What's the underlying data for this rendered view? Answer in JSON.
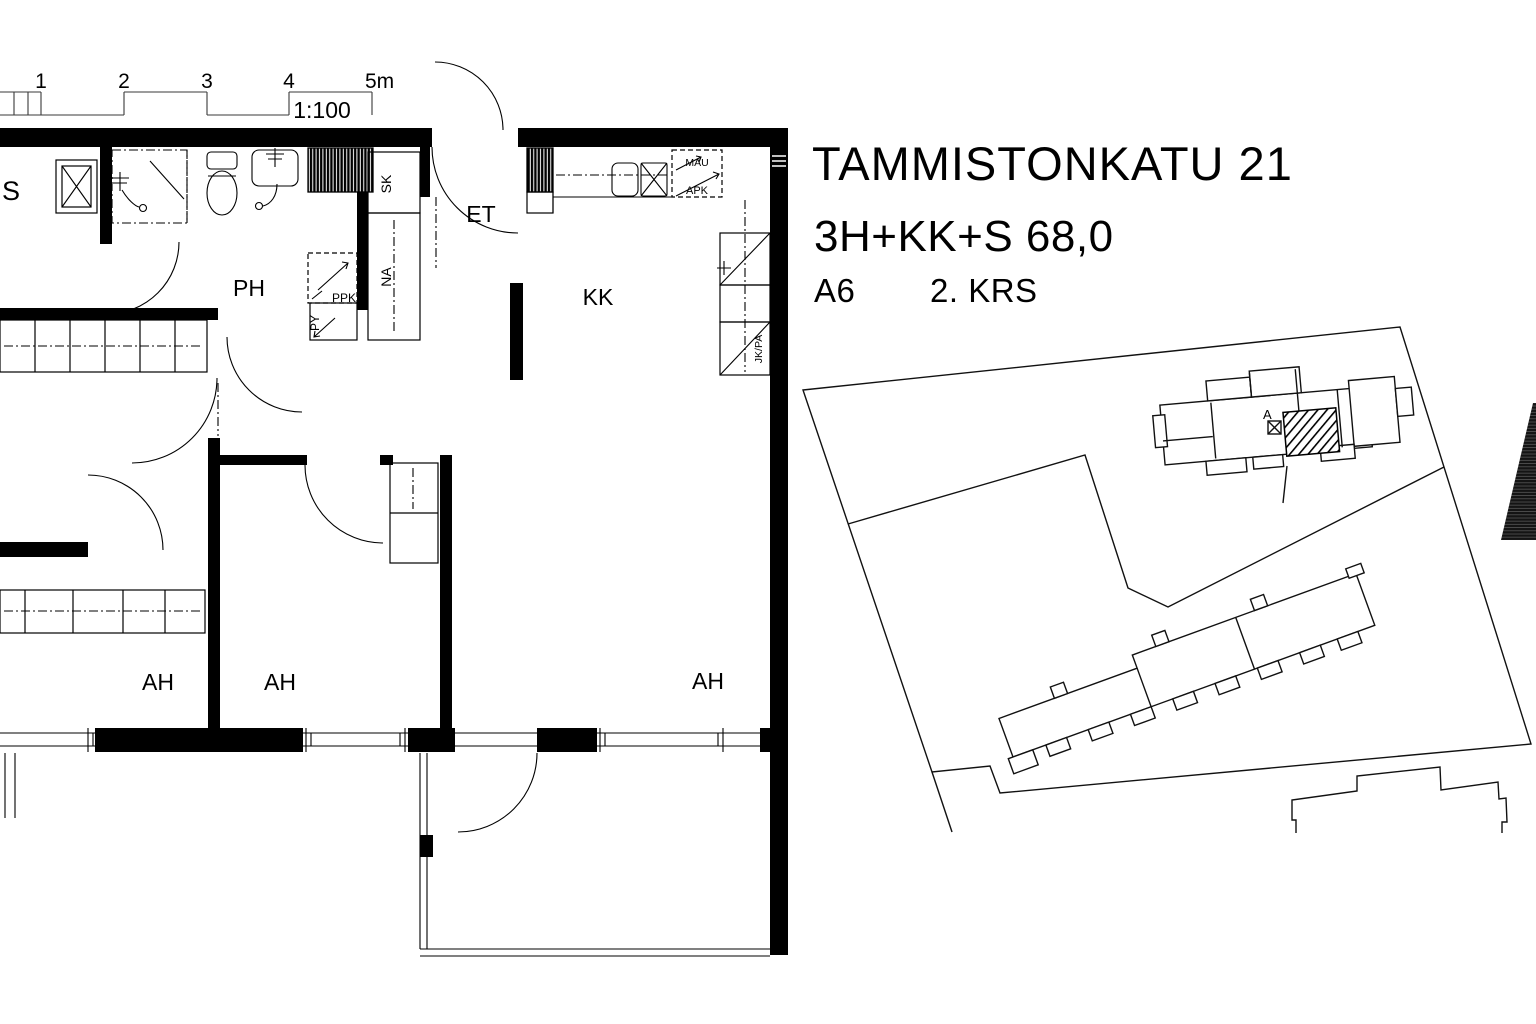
{
  "colors": {
    "ink": "#000000",
    "paper": "#ffffff"
  },
  "title_block": {
    "address": "TAMMISTONKATU 21",
    "layout_area": "3H+KK+S 68,0",
    "unit": "A6",
    "floor": "2. KRS"
  },
  "scale_bar": {
    "ticks": [
      "1",
      "2",
      "3",
      "4",
      "5m"
    ],
    "ratio": "1:100"
  },
  "rooms": {
    "sauna": "S",
    "bathroom": "PH",
    "entry": "ET",
    "kitchenette": "KK",
    "room1": "AH",
    "room2": "AH",
    "room3": "AH"
  },
  "fixtures": {
    "broom_closet": "SK",
    "coat_closet": "NA",
    "washer": "PPK",
    "linen_cabinet": "PY",
    "microwave": "MAU",
    "dishwasher": "APK",
    "fridge_freezer": "JK/PA"
  },
  "site_plan": {
    "stairwell_label": "A"
  }
}
